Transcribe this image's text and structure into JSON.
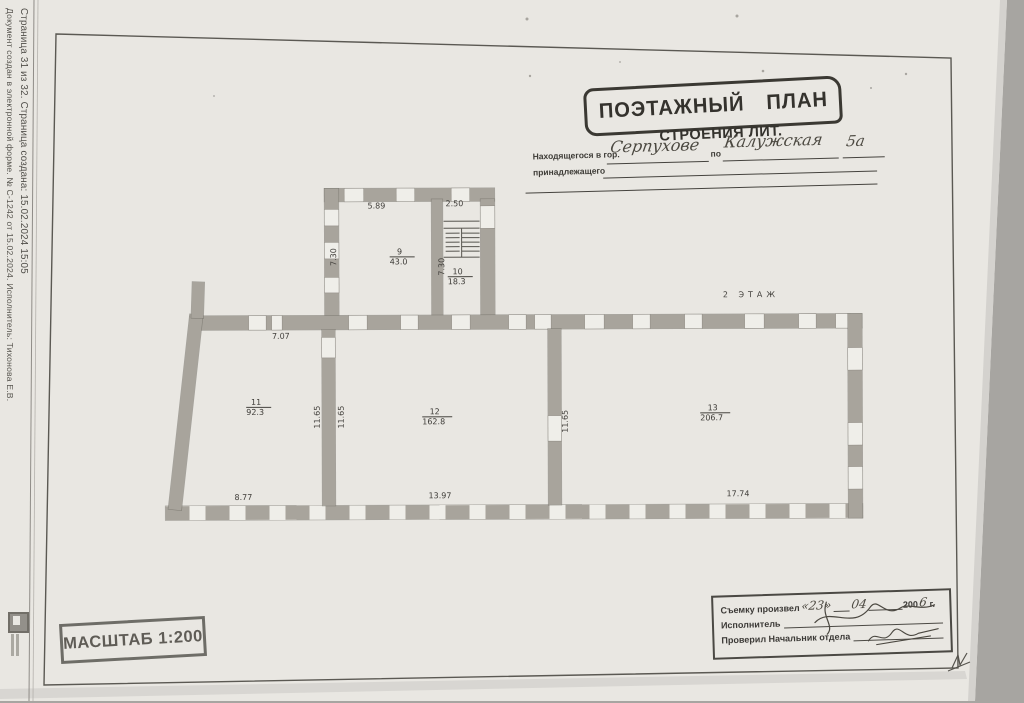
{
  "document": {
    "footer_line1": "Документ создан в электронной форме. № С-1242 от 15.02.2024. Исполнитель: Тихонова Е.В.",
    "footer_line2": "Страница 31 из 32. Страница создана: 15.02.2024 15:05"
  },
  "header_stamp": {
    "title": "ПОЭТАЖНЫЙ ПЛАН",
    "subtitle": "СТРОЕНИЯ ЛИТ.",
    "located_label": "Находящегося в гор.",
    "city": "Серпухове",
    "po_label": "по",
    "street": "Калужская",
    "house": "5а",
    "owner_label": "принадлежащего"
  },
  "plan": {
    "floor_label": "2 ЭТАЖ",
    "rooms": [
      {
        "number": "9",
        "area": "43.0"
      },
      {
        "number": "10",
        "area": "18.3"
      },
      {
        "number": "11",
        "area": "92.3"
      },
      {
        "number": "12",
        "area": "162.8"
      },
      {
        "number": "13",
        "area": "206.7"
      }
    ],
    "dims": {
      "room9_top": "5.89",
      "room9_left": "7.30",
      "room10_top": "2.50",
      "room10_left": "7.30",
      "room11_top": "7.07",
      "room11_bottom": "8.77",
      "wall11_12_left": "11.65",
      "wall11_12_right": "11.65",
      "wall12_13": "11.65",
      "room12_bottom": "13.97",
      "room13_bottom": "17.74"
    }
  },
  "scale_stamp": {
    "text": "МАСШТАБ 1:200"
  },
  "survey_stamp": {
    "row1_label": "Съемку произвел",
    "day": "«23»",
    "month": "04",
    "year_printed": "200",
    "year_hw": "6",
    "year_suffix": "г.",
    "row2_label": "Исполнитель",
    "row3_label": "Проверил Начальник отдела"
  },
  "colors": {
    "paper": "#e9e7e2",
    "wall": "#a8a49c",
    "ink": "#34322d"
  }
}
